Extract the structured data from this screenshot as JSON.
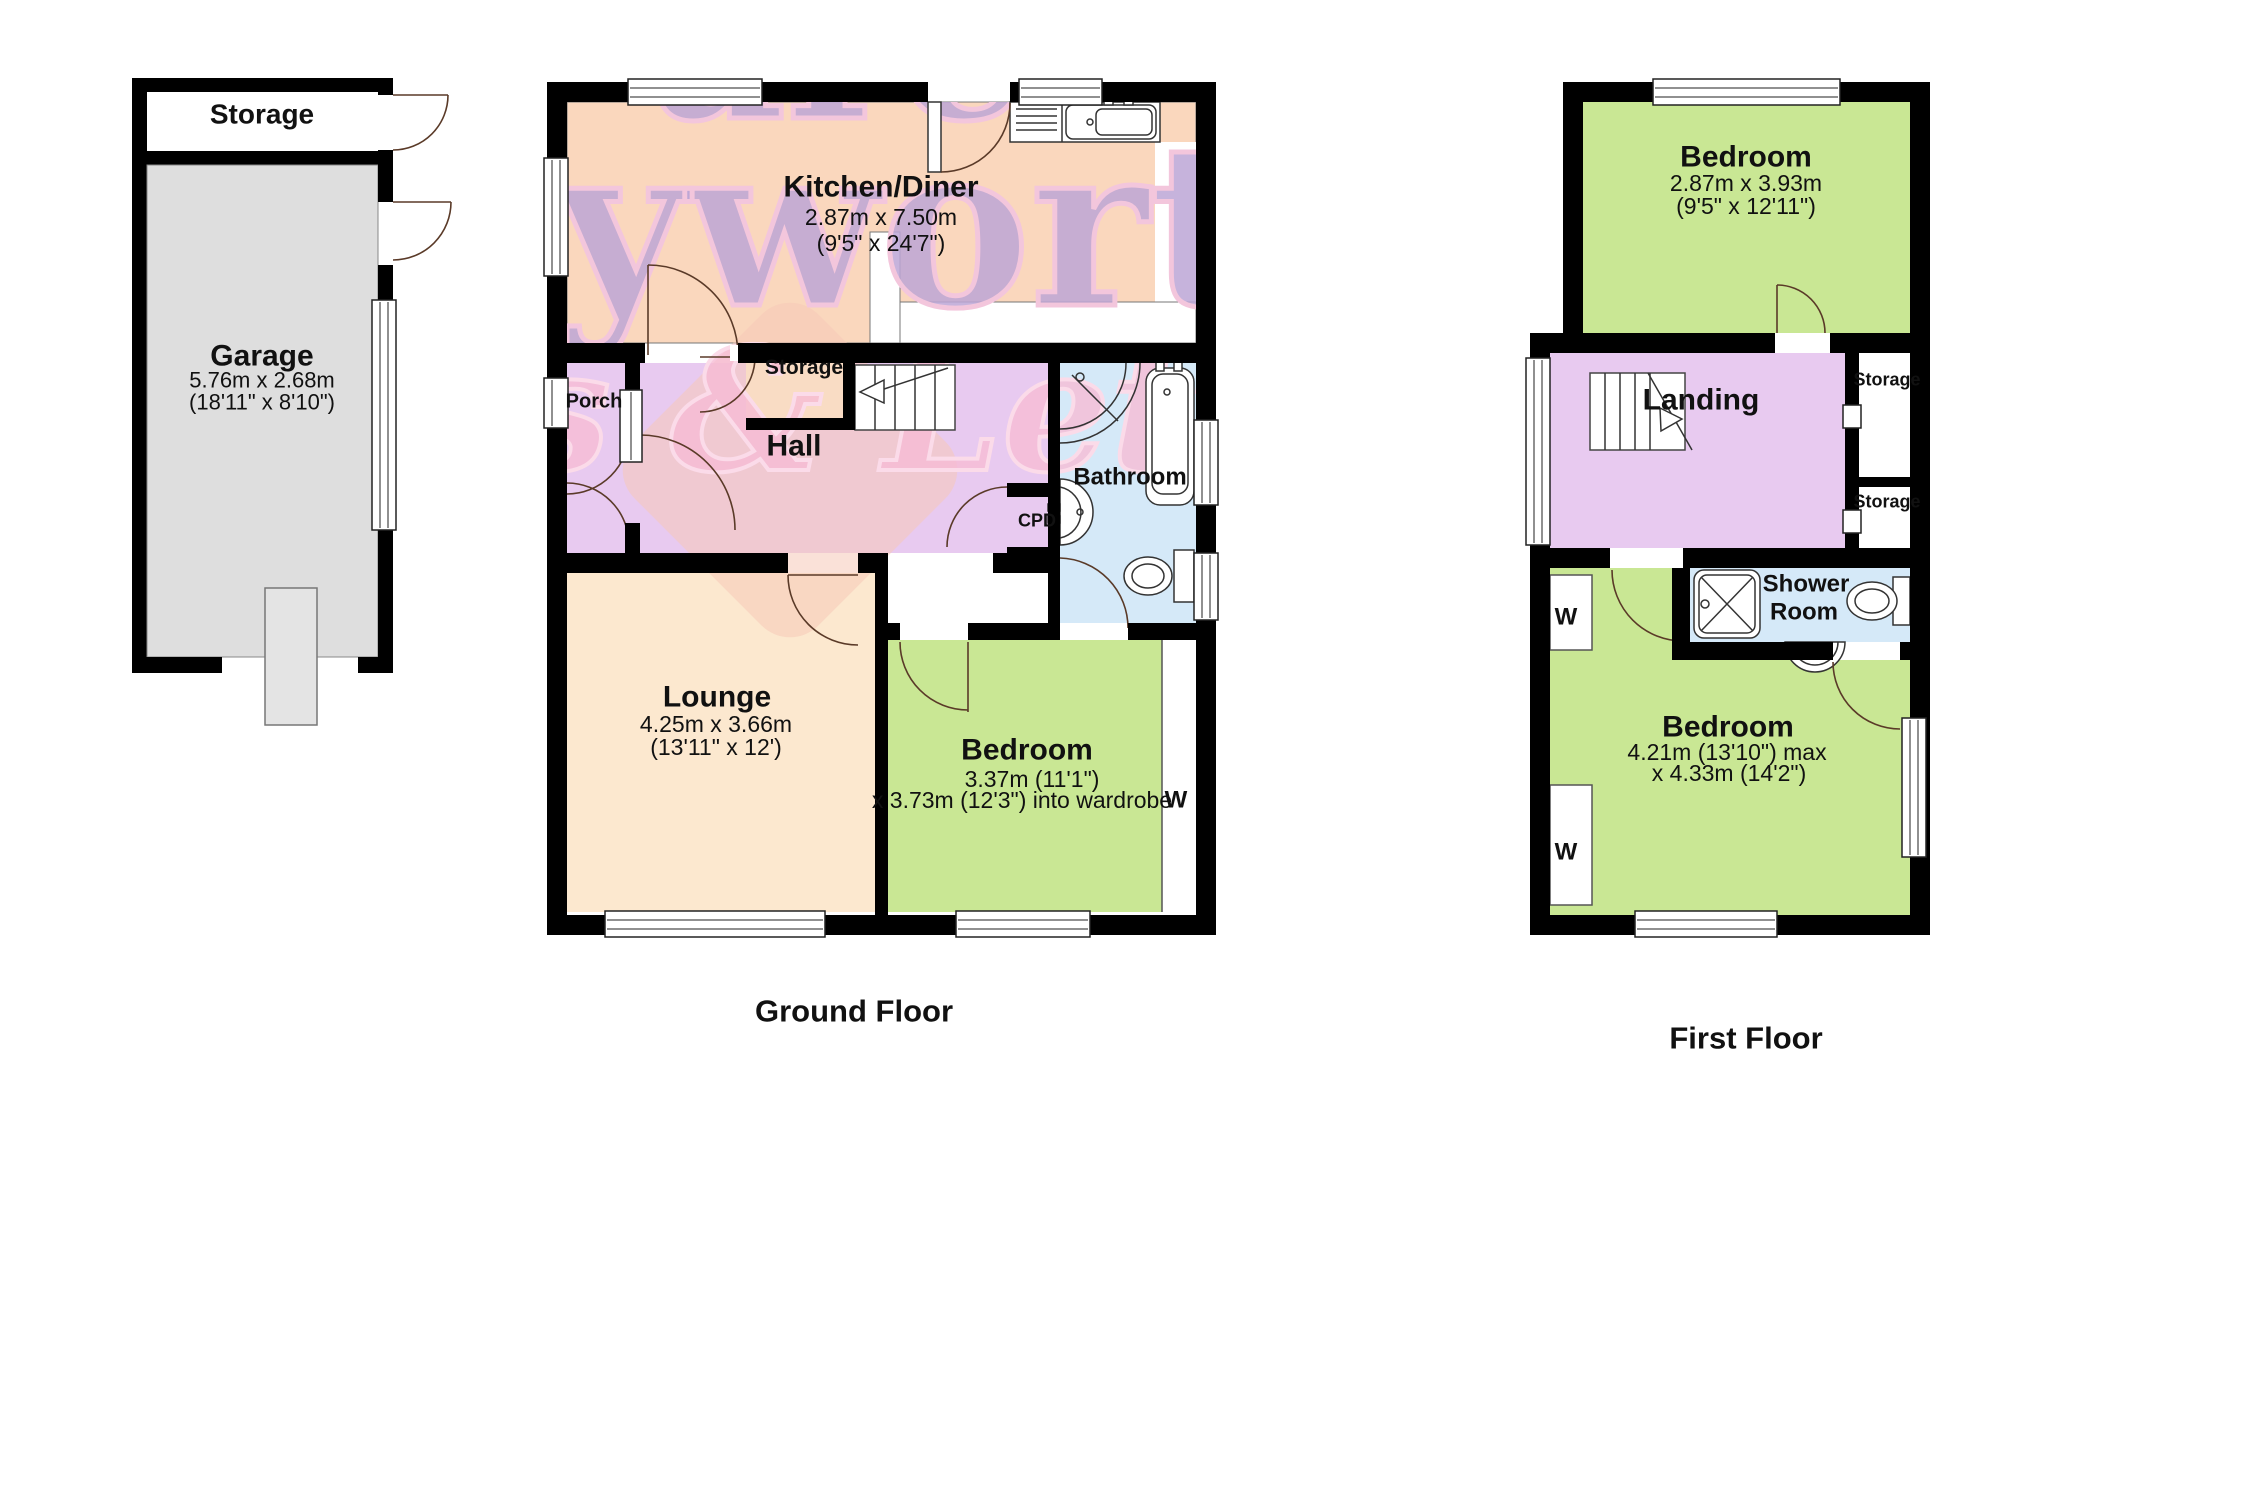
{
  "page_title": "Property floor plan",
  "colors": {
    "wall": "#000000",
    "kitchen_fill": "#fad7bd",
    "hall_fill": "#e8caf0",
    "storage_closet_fill": "#fdf4d2",
    "bathroom_fill": "#d5e9f8",
    "lounge_fill": "#fce8cf",
    "bedroom_fill": "#c9e794",
    "garage_fill": "#dedede",
    "watermark_purple": "#bca6d6",
    "watermark_pink": "#f6bcd4"
  },
  "watermark": {
    "line1": "are",
    "line2": "yworth",
    "line3": "s & Lettings"
  },
  "garage_block": {
    "storage_label": "Storage",
    "garage_name": "Garage",
    "garage_dim_metric": "5.76m x 2.68m",
    "garage_dim_imperial": "(18'11\" x 8'10\")"
  },
  "ground_floor": {
    "caption": "Ground Floor",
    "kitchen": {
      "name": "Kitchen/Diner",
      "dim_metric": "2.87m x 7.50m",
      "dim_imperial": "(9'5\" x 24'7\")"
    },
    "porch": {
      "name": "Porch"
    },
    "storage_closet": {
      "name": "Storage"
    },
    "hall": {
      "name": "Hall"
    },
    "cpd": {
      "name": "CPD"
    },
    "bathroom": {
      "name": "Bathroom"
    },
    "lounge": {
      "name": "Lounge",
      "dim_metric": "4.25m x 3.66m",
      "dim_imperial": "(13'11\" x 12')"
    },
    "bedroom": {
      "name": "Bedroom",
      "dim_line1": "3.37m (11'1\")",
      "dim_line2": "x 3.73m (12'3\") into wardrobe",
      "wardrobe": "W"
    }
  },
  "first_floor": {
    "caption": "First Floor",
    "bedroom_front": {
      "name": "Bedroom",
      "dim_metric": "2.87m x 3.93m",
      "dim_imperial": "(9'5\" x 12'11\")"
    },
    "landing": {
      "name": "Landing"
    },
    "storage_upper": {
      "name": "Storage"
    },
    "storage_lower": {
      "name": "Storage"
    },
    "shower_room": {
      "line1": "Shower",
      "line2": "Room"
    },
    "bedroom_rear": {
      "name": "Bedroom",
      "dim_line1": "4.21m (13'10\") max",
      "dim_line2": "x 4.33m (14'2\")",
      "wardrobe_top": "W",
      "wardrobe_bottom": "W"
    }
  }
}
